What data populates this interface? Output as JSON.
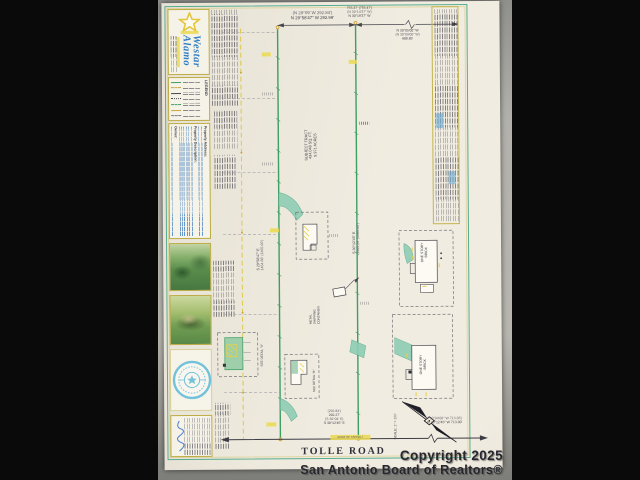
{
  "photo": {
    "watermark": {
      "line1": "Copyright 2025",
      "line2": "San Antonio Board of Realtors®"
    }
  },
  "title_block": {
    "logo": {
      "name_line1": "Westar",
      "name_line2": "Alamo"
    },
    "legend_title": "LEGEND",
    "property": {
      "address_label": "Property Address:",
      "description_label": "Property Description:",
      "owner_label": "Owner:"
    }
  },
  "plat": {
    "road_name": "TOLLE ROAD",
    "scale_label": "SCALE: 1\" = 100'",
    "subject_tract": {
      "line1": "SUBJECT TRACT",
      "line2": "434,048 SQ. FT.",
      "line3": "9.971 ACRES"
    },
    "bearings": {
      "top_left": {
        "record": "(N 29°09' W  292.84')",
        "measured": "N 29°58'47\" W  292.99'"
      },
      "top_middle": {
        "distance": "755.37' (755.47')",
        "record": "(N 30°14'37\" W)",
        "measured": "N 30°19'37\" W"
      },
      "top_right": {
        "measured": "N 30°05'00\" W",
        "record": "(N 30°09'00\" W)",
        "distance": "680.85'"
      },
      "west_line": {
        "measured": "S 29°58'47\" E",
        "distance": "1464.88' (1465.00')"
      },
      "center_line": {
        "measured": "S 30°12'45\" E",
        "distance": "1465.20' (1465.00')"
      },
      "bottom_middle": {
        "record_distance": "(292.84')",
        "distance": "292.27'",
        "record": "(S 30°04' E)",
        "measured": "S 30°12'45\" E"
      },
      "bottom_right": {
        "record": "(N 30°04'00\" W  713.36')",
        "measured": "N 30°12'45\" W  713.00'"
      }
    },
    "labels": {
      "container_line1": "METAL",
      "container_line2": "SHIPPING",
      "container_line3": "CONTAINER",
      "one_story_brick_1_line1": "ONE STORY",
      "one_story_brick_1_line2": "BRICK",
      "one_story_brick_2_line1": "ONE STORY",
      "one_story_brick_2_line2": "BRICK",
      "see_detail_a": "SEE DETAIL \"A\"",
      "see_detail_b": "SEE DETAIL \"B\"",
      "edge_of_asphalt": "EDGE OF ASPHALT"
    }
  }
}
